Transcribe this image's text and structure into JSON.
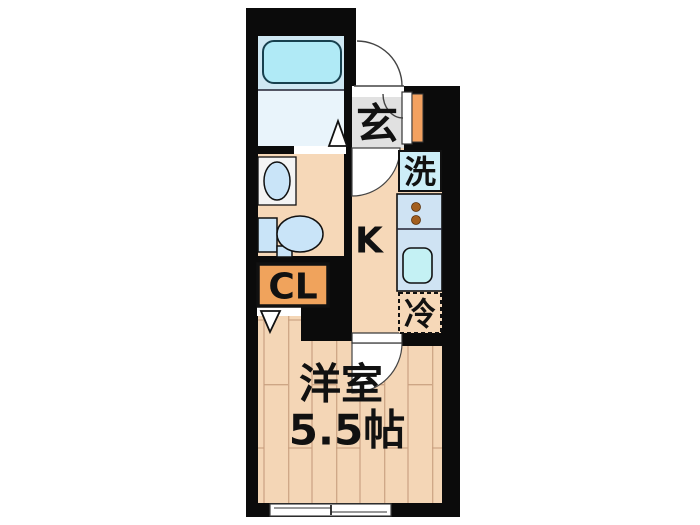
{
  "palette": {
    "wall": "#0b0b0b",
    "bath_floor_upper": "#cfe8f3",
    "bath_floor_lower": "#e9f4fb",
    "tub": "#b0eaf6",
    "fixture_blue": "#c9e4f8",
    "sink_cyan": "#c4f1f4",
    "counter_blue": "#cfe3f3",
    "appliance_bg": "#cdeef8",
    "burner_brown": "#a35f1e",
    "genkan_gray": "#e1e1e1",
    "door_orange": "#f2a160",
    "closet_orange": "#f0a35c",
    "kitchen_floor": "#f6d8b8",
    "wood_floor": "#f4d6b6",
    "wood_line": "#c79e7d",
    "arc_line": "#444444"
  },
  "floor_plan": {
    "labels": {
      "entrance": "玄",
      "washing_machine": "洗",
      "kitchen": "K",
      "refrigerator": "冷",
      "closet": "CL",
      "room_name": "洋室",
      "room_size": "5.5帖"
    }
  }
}
